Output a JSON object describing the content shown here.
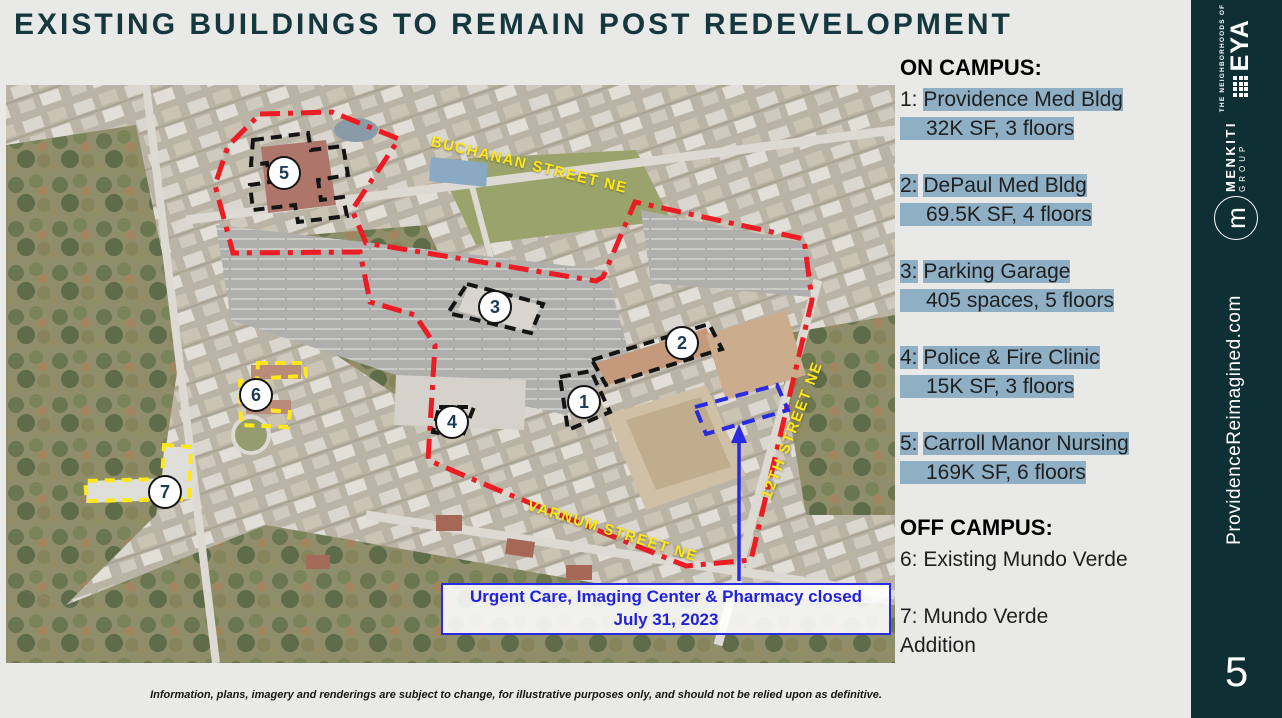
{
  "slide": {
    "title": "EXISTING BUILDINGS TO REMAIN POST REDEVELOPMENT",
    "page_number": "5",
    "disclaimer": "Information, plans, imagery and renderings are subject to change, for illustrative purposes only, and should not be relied upon as definitive."
  },
  "legend": {
    "on_campus_heading": "ON CAMPUS:",
    "off_campus_heading": "OFF CAMPUS:",
    "items": [
      {
        "num": "1:",
        "name": "Providence Med Bldg",
        "detail": "32K SF, 3 floors"
      },
      {
        "num": "2:",
        "name": "DePaul Med Bldg",
        "detail": "69.5K SF, 4 floors"
      },
      {
        "num": "3:",
        "name": "Parking Garage",
        "detail": "405 spaces, 5 floors"
      },
      {
        "num": "4:",
        "name": "Police & Fire Clinic",
        "detail": "15K SF, 3 floors"
      },
      {
        "num": "5:",
        "name": "Carroll Manor Nursing",
        "detail": "169K SF, 6 floors"
      }
    ],
    "off_items": [
      "6: Existing Mundo Verde",
      "7: Mundo Verde Addition"
    ],
    "highlight_color": "#8fafc5"
  },
  "map": {
    "streets": {
      "buchanan": "BUCHANAN STREET NE",
      "varnum": "VARNUM STREET NE",
      "twelfth": "12TH STREET NE"
    },
    "markers": [
      "1",
      "2",
      "3",
      "4",
      "5",
      "6",
      "7"
    ],
    "callout": "Urgent Care, Imaging Center & Pharmacy closed July 31, 2023",
    "colors": {
      "campus_boundary": "#ec1c24",
      "building_outline": "#141414",
      "offsite_outline": "#ffe81a",
      "closed_outline": "#2a2ae0"
    }
  },
  "sidebar": {
    "eya_tagline": "THE NEIGHBORHOODS OF",
    "eya_name": "EYA",
    "menkiti_name": "MENKITI",
    "menkiti_sub": "GROUP",
    "monogram": "m",
    "website": "ProvidenceReimagined.com"
  }
}
